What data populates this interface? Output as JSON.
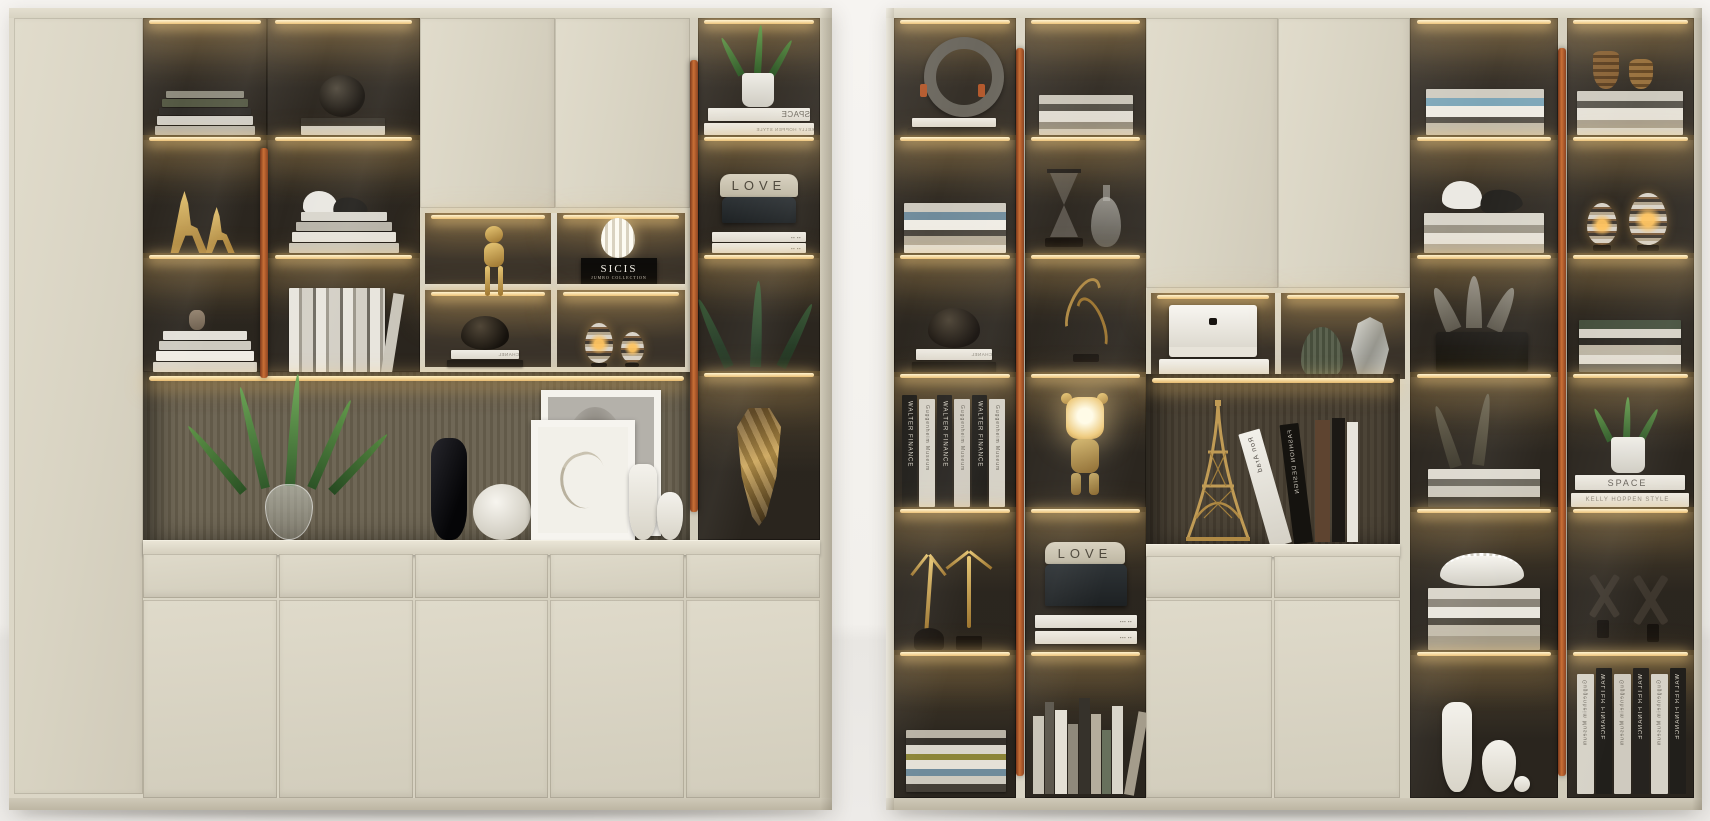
{
  "scene": {
    "type": "photorealistic 3D interior render",
    "subject": "Two modern floor-to-ceiling display cabinets in cream lacquer with smoked-glass doors, copper pull handles and warm LED-lit shelves staged with books and decor objects",
    "units": 2
  },
  "colors": {
    "wall": "#f3f1ed",
    "floor": "#eceae7",
    "cabinet_cream": "#d8d3c2",
    "cabinet_shadow": "#c6c0ae",
    "glass_interior": "#2c2720",
    "led_glow": "#ffe9b0",
    "copper_handle": "#b45c2c",
    "niche_back_slats": "#6f6756",
    "niche_back_dark": "#4a4336",
    "gold_accent": "#c9a050",
    "black_accent": "#17130f"
  },
  "texts": {
    "sicis": "SICIS",
    "jumbo_collection": "JUMBO COLLECTION",
    "love": "LOVE",
    "space": "SPACE",
    "kelly_hoppen": "KELLY HOPPEN STYLE",
    "chanel": "CHANEL",
    "walter_finance": "WALTER FINANCE",
    "guggenheim": "Guggenheim Museum",
    "ron_arad": "Ron Arad",
    "fashion_design": "FASHION DESIGN"
  },
  "left_cabinet": {
    "sections": [
      "tall plain side door",
      "two glass display columns with LED shelves",
      "upper lacquer double doors",
      "central 2x2 lit display niche",
      "right glass display column",
      "open niche with slatted back panel",
      "five drawers",
      "five lower doors"
    ],
    "display_items": [
      "book stacks",
      "gold deer figurines",
      "dark sphere vase",
      "white dove figurine",
      "black bird figurine",
      "leaning white books",
      "gold monkey figurine",
      "white gourd lamp on SICIS box",
      "dark bowl on CHANEL book",
      "striped candle eggs",
      "potted plant over SPACE books",
      "LOVE sign board with storage box",
      "white books",
      "dark ferns",
      "gold polygonal mask",
      "houseplant in glass vase",
      "black tall vase",
      "carved white sphere vase",
      "two framed horse artworks",
      "white jug vases"
    ]
  },
  "right_cabinet": {
    "sections": [
      "four glass display columns with LED shelves",
      "upper lacquer double doors",
      "lit niche with two display cells",
      "open lit niche",
      "two drawers",
      "two lower doors"
    ],
    "display_items": [
      "grey ring sculpture",
      "book stacks",
      "dark bowl on CHANEL book",
      "WALTER FINANCE and Guggenheim Museum book spines",
      "gold dancer figurines",
      "stacked books",
      "hourglass",
      "glass decanter",
      "gold antler sculpture",
      "glowing bear lamp",
      "LOVE sign board with box",
      "standing book row",
      "white gift boxes",
      "green ribbed vase",
      "faceted glass vase",
      "Eiffel Tower model",
      "leaning designer books (Ron Arad, FASHION DESIGN)",
      "bird figurines",
      "leaf fan ornament",
      "dried fern with books",
      "scalloped bowl on books",
      "white jug vases",
      "bronze woven vases",
      "striped candle eggs",
      "potted plant over SPACE books",
      "dark X sculptures",
      "mirrored WALTER FINANCE spines"
    ]
  }
}
